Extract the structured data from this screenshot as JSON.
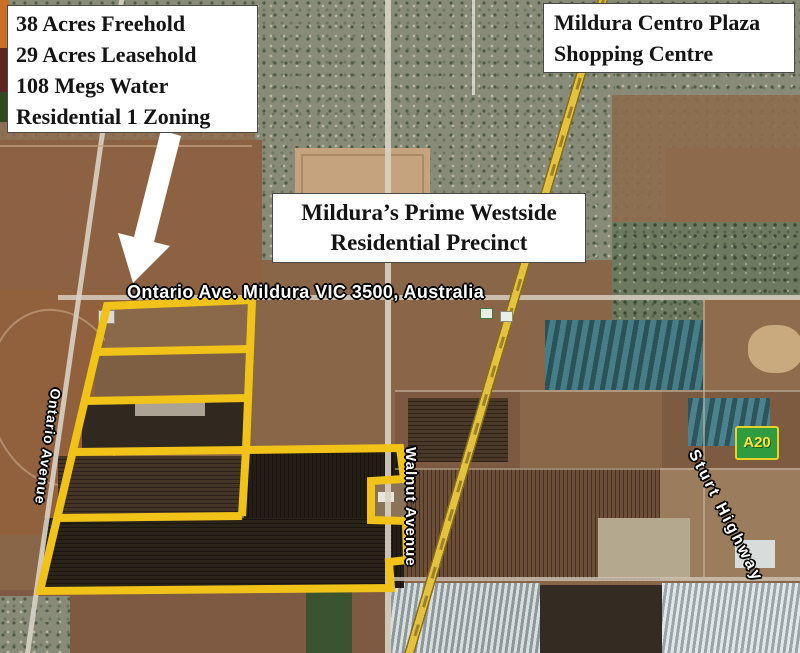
{
  "callout_property": {
    "lines": [
      "38 Acres Freehold",
      "29 Acres Leasehold",
      "108 Megs Water",
      "Residential 1 Zoning"
    ]
  },
  "callout_shopping": {
    "lines": [
      "Mildura Centro Plaza",
      "Shopping Centre"
    ]
  },
  "callout_precinct": {
    "lines": [
      "Mildura’s Prime Westside",
      "Residential Precinct"
    ]
  },
  "map_labels": {
    "address": "Ontario Ave. Mildura VIC 3500, Australia",
    "walnut": "Walnut Avenue",
    "ontario": "Ontario Avenue",
    "sturt": "Sturt Highway",
    "shield": "A20"
  },
  "colors": {
    "boundary": "#F1C319",
    "highway": "#E3C23F",
    "shield_bg": "#2E9C3F",
    "shield_border": "#E8D22A",
    "shield_text": "#FFE13B",
    "callout_bg": "#FFFFFF",
    "callout_text": "#141414",
    "label_text": "#FFFFFF",
    "arrow": "#FFFFFF"
  }
}
